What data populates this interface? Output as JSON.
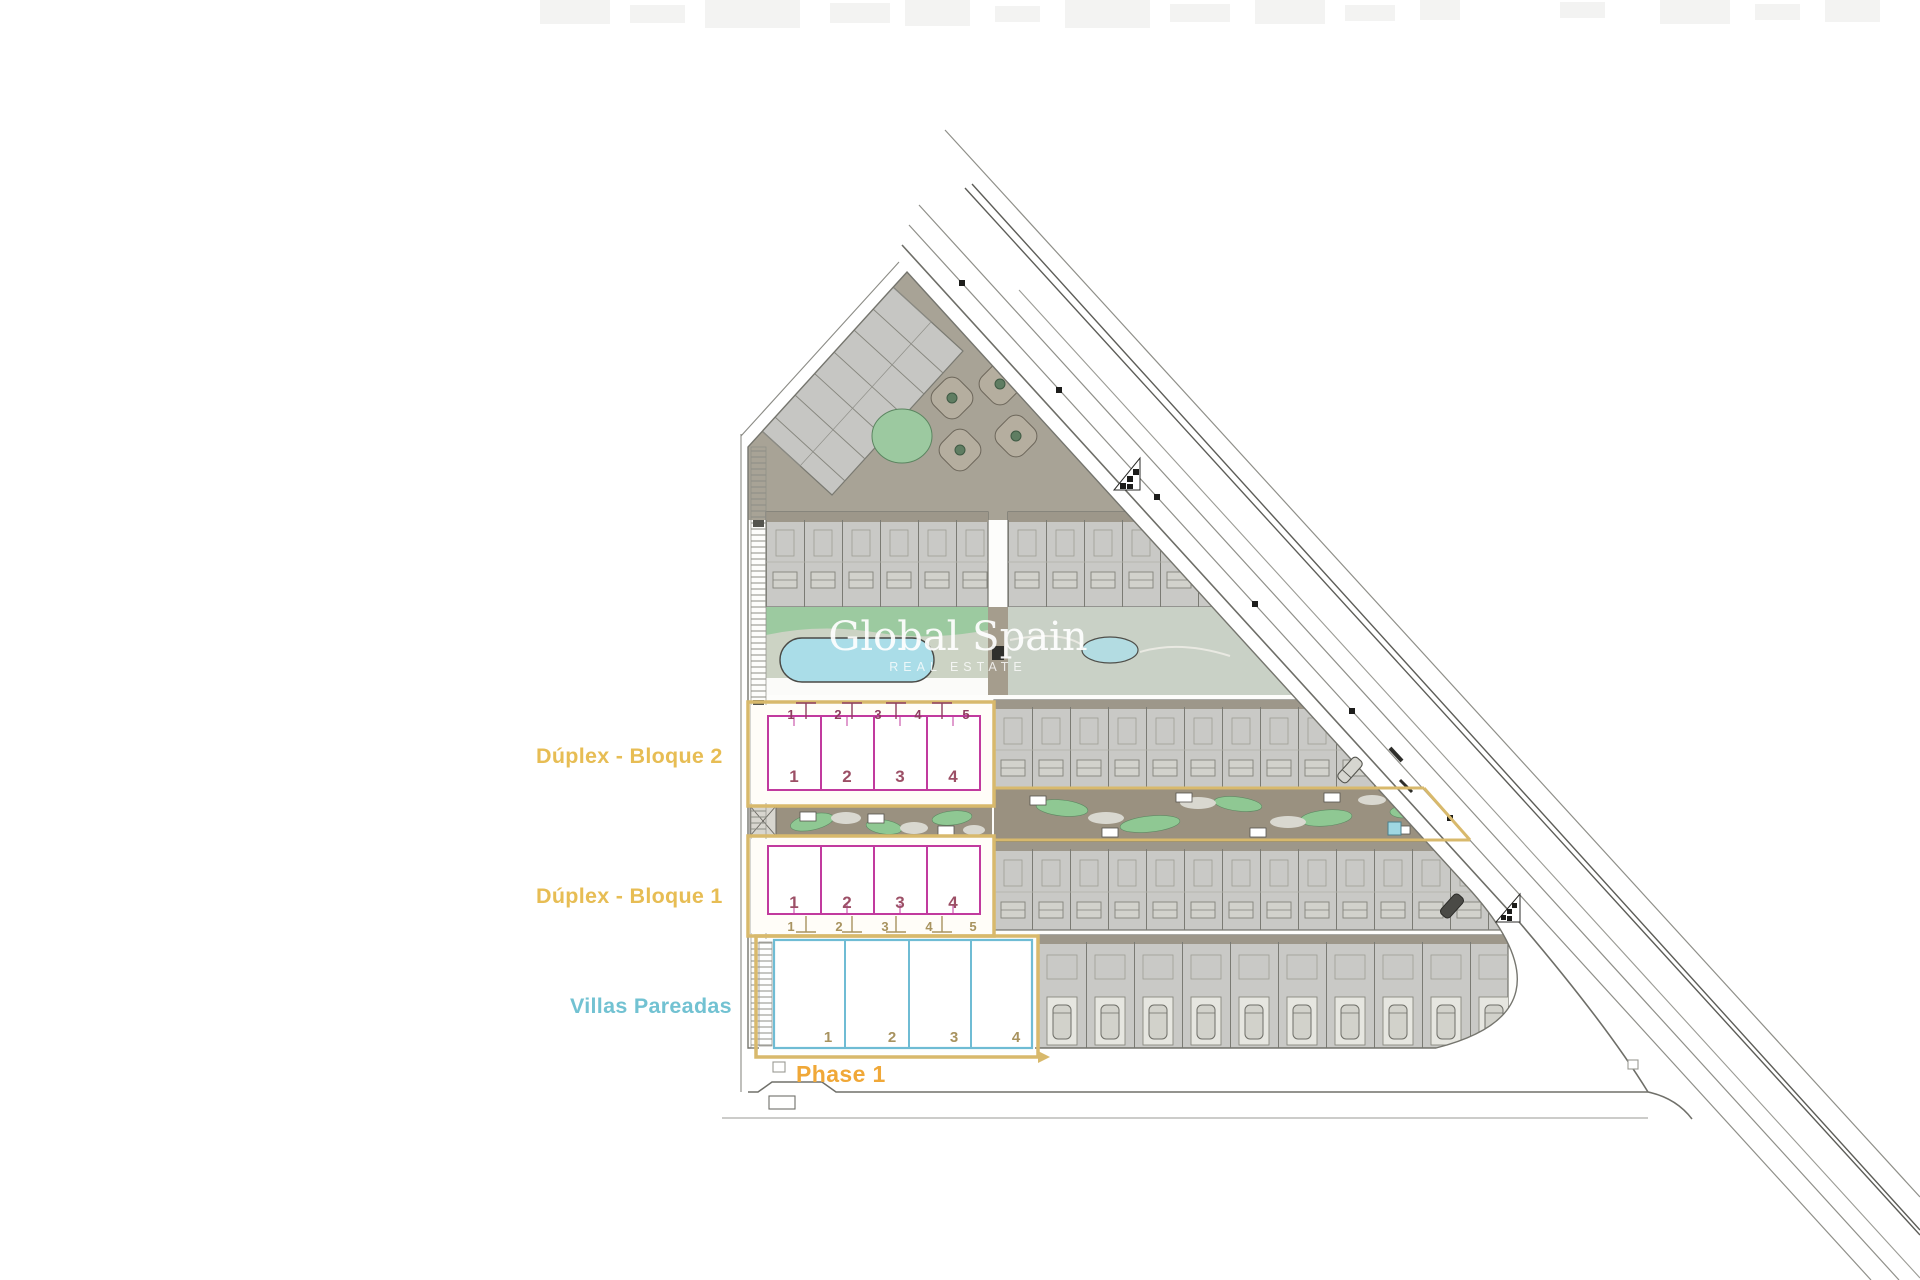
{
  "watermark": {
    "name": "Global Spain",
    "tagline": "REAL ESTATE"
  },
  "legend": {
    "bloque2": "Dúplex - Bloque 2",
    "bloque1": "Dúplex - Bloque 1",
    "villas": "Villas Pareadas",
    "phase": "Phase 1"
  },
  "blocks": {
    "bloque2": {
      "parcels": [
        "1",
        "2",
        "3",
        "4",
        "5"
      ],
      "units": [
        "1",
        "2",
        "3",
        "4"
      ]
    },
    "bloque1": {
      "units": [
        "1",
        "2",
        "3",
        "4"
      ],
      "parcels": [
        "1",
        "2",
        "3",
        "4",
        "5"
      ]
    },
    "villas": {
      "units": [
        "1",
        "2",
        "3",
        "4"
      ]
    }
  },
  "colors": {
    "label_gold": "#E7BD54",
    "phase_orange": "#F0A838",
    "villas_blue": "#72C2D2",
    "unit_magenta": "#C13A9E",
    "unit_number": "#9C4F66",
    "parcel_magenta": "#8E3D5E",
    "parcel_tan": "#A8935F",
    "phase_outline": "#D8B96C",
    "pool_blue": "#AADDE8",
    "pond_blue": "#B3DCE2",
    "grass_green": "#9CCAA0",
    "garden_green": "#8FC893",
    "garden_taupe": "#9A9180",
    "building_gray": "#C9C9C6",
    "paving_taupe": "#A8A396"
  }
}
